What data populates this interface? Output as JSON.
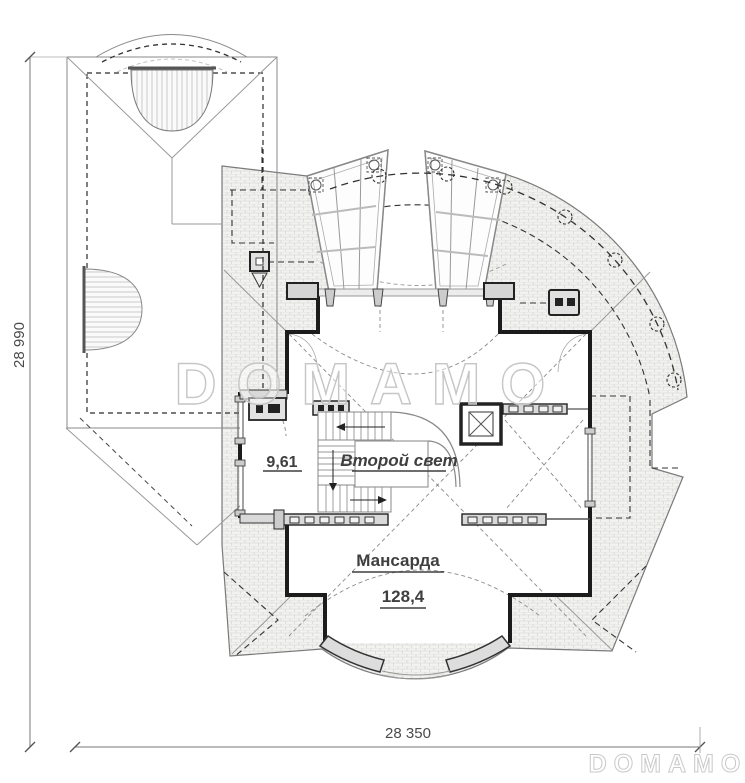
{
  "plan": {
    "title": "attic floor plan",
    "rooms": {
      "small_room_area": "9,61",
      "void_label": "Второй свет",
      "attic_label": "Мансарда",
      "attic_area": "128,4"
    },
    "dimensions": {
      "vertical": "28 990",
      "horizontal": "28 350"
    },
    "watermarks": {
      "center": "DOMAMO",
      "corner": "DOMAMO"
    },
    "colors": {
      "wall": "#1c1c1c",
      "thin_line": "#8a8a8a",
      "hatch_line": "#d2d2cf",
      "label_text": "#3f3f3f",
      "watermark": "#c6c6c6"
    }
  }
}
